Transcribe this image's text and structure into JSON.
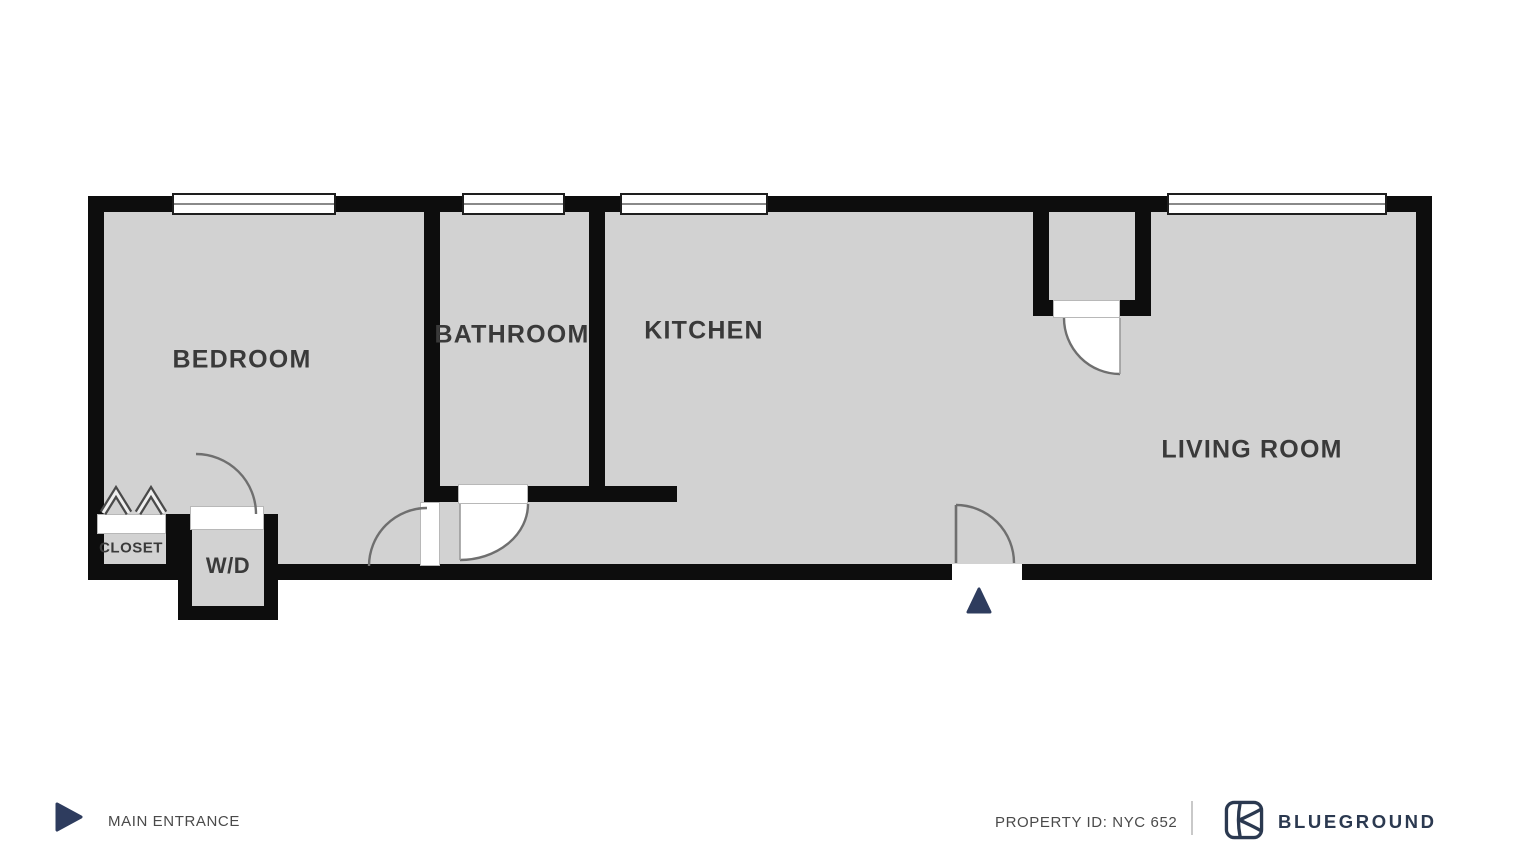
{
  "colors": {
    "wall": "#0d0d0d",
    "floor": "#d2d2d2",
    "door_arc": "#6f6f6f",
    "room_label": "#3a3a3a",
    "footer_text": "#4a4a4a",
    "brand_navy": "#2b3950",
    "entrance_marker": "#2e3c5e",
    "divider": "#c9c9c9"
  },
  "plan": {
    "rooms": [
      {
        "id": "bedroom",
        "label": "BEDROOM"
      },
      {
        "id": "bathroom",
        "label": "BATHROOM"
      },
      {
        "id": "kitchen",
        "label": "KITCHEN"
      },
      {
        "id": "living-room",
        "label": "LIVING ROOM"
      },
      {
        "id": "closet",
        "label": "CLOSET"
      },
      {
        "id": "washer-dryer",
        "label": "W/D"
      }
    ]
  },
  "legend": {
    "entrance_icon": "right-triangle-icon",
    "main_entrance_label": "MAIN ENTRANCE"
  },
  "footer": {
    "property_id": "PROPERTY ID: NYC 652",
    "brand": "BLUEGROUND",
    "brand_icon": "blueground-logo"
  }
}
